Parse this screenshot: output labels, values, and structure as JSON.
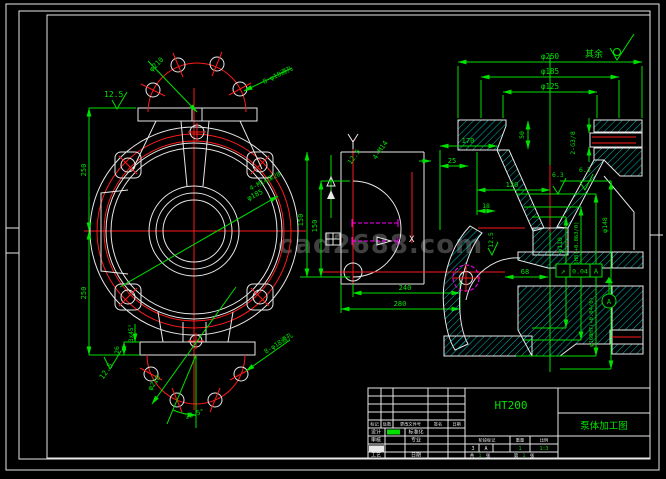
{
  "sheet": {
    "watermark": "cad2688.com",
    "surface_note": {
      "label": "其余"
    }
  },
  "front_view": {
    "roughness_top": "12.5",
    "roughness_bottom": "12.5",
    "dim_left_upper": "250",
    "dim_left_lower": "250",
    "bolt_circle_top": {
      "dia": "φ210",
      "holes": "8-φ18通孔"
    },
    "bolt_circle_bottom": {
      "dia": "φ210",
      "holes": "8-φ18通孔",
      "angle": "22.5°"
    },
    "hub": {
      "thread": "4-M14深28",
      "dia": "φ185"
    },
    "flange": {
      "thickness": "26",
      "chamfer": "3x45°"
    }
  },
  "side_view": {
    "roughness": "12.5",
    "thread": "4-M14",
    "dim_upper": "150",
    "dim_lower": "150",
    "dim_240": "240",
    "dim_280": "280",
    "label_x": "X"
  },
  "section_view": {
    "dim_d250": "φ250",
    "dim_d185": "φ185",
    "dim_d125": "φ125",
    "dim_170": "170",
    "dim_25": "25",
    "dim_50": "50",
    "port": "2-G3/8",
    "dim_120": "120",
    "dim_18": "18",
    "dim_68": "68",
    "rough_a": "6.3",
    "rough_b": "6.3",
    "rough_c": "12.5",
    "dim_d110": "φ110",
    "dim_d125h8": "φ125H8(+0.063/0)",
    "dim_d160h7": "φ160H7(+0.04/0)",
    "dim_d148": "φ148",
    "fcf": {
      "symbol": "↗",
      "tolerance": "0.04",
      "datum": "A"
    },
    "datum": "A"
  },
  "title_block": {
    "material": "HT200",
    "title": "泵体加工图",
    "headers": [
      "标记",
      "处数",
      "更改文件号",
      "签名",
      "日期"
    ],
    "row_labels": [
      [
        "设计",
        "标准化"
      ],
      [
        "审核",
        "专业"
      ],
      [
        "工艺",
        "日期"
      ]
    ],
    "stage": {
      "labels": [
        "阶段标记",
        "重量",
        "比例"
      ],
      "values": [
        "3",
        "A",
        "1",
        "1:3"
      ]
    },
    "sheet_row": {
      "gong": "共",
      "n1": "1",
      "zhang1": "张",
      "di": "第",
      "n2": "1",
      "zhang2": "张"
    }
  }
}
